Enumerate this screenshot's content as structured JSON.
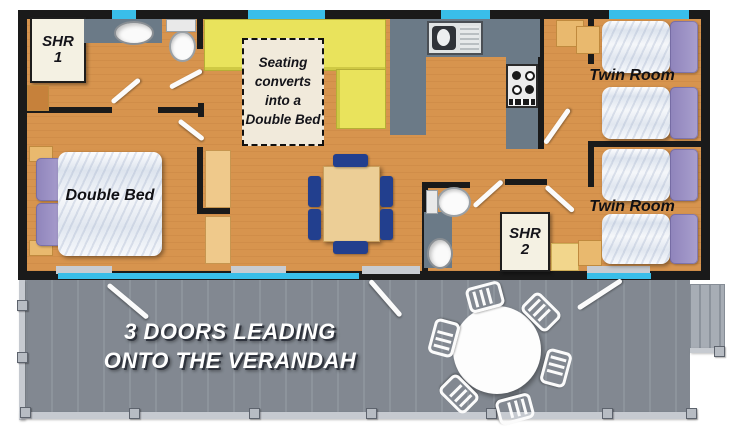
{
  "plan": {
    "rooms": {
      "shower_room_1": {
        "abbr": "SHR",
        "number": "1"
      },
      "shower_room_2": {
        "abbr": "SHR",
        "number": "2"
      },
      "twin_room_1": {
        "label": "Twin Room"
      },
      "twin_room_2": {
        "label": "Twin Room"
      },
      "double_bedroom": {
        "label": "Double Bed"
      },
      "lounge": {
        "seating_note": "Seating converts into a Double Bed"
      }
    },
    "verandah": {
      "note_line1": "3 DOORS LEADING",
      "note_line2": "ONTO THE VERANDAH"
    },
    "colors": {
      "floor": "#D7944E",
      "wall": "#1A1A1A",
      "window": "#39BEE9",
      "kitchen_counter": "#6B7A87",
      "seating": "#E9E35C",
      "verandah": "#878E97",
      "verandah_rail": "#C6CAD0",
      "pillow": "#9C92C4",
      "bedding": "#F2F4F8",
      "chair": "#223F8E",
      "table_wood": "#ECCE96",
      "note_box": "#F1EADB"
    }
  }
}
